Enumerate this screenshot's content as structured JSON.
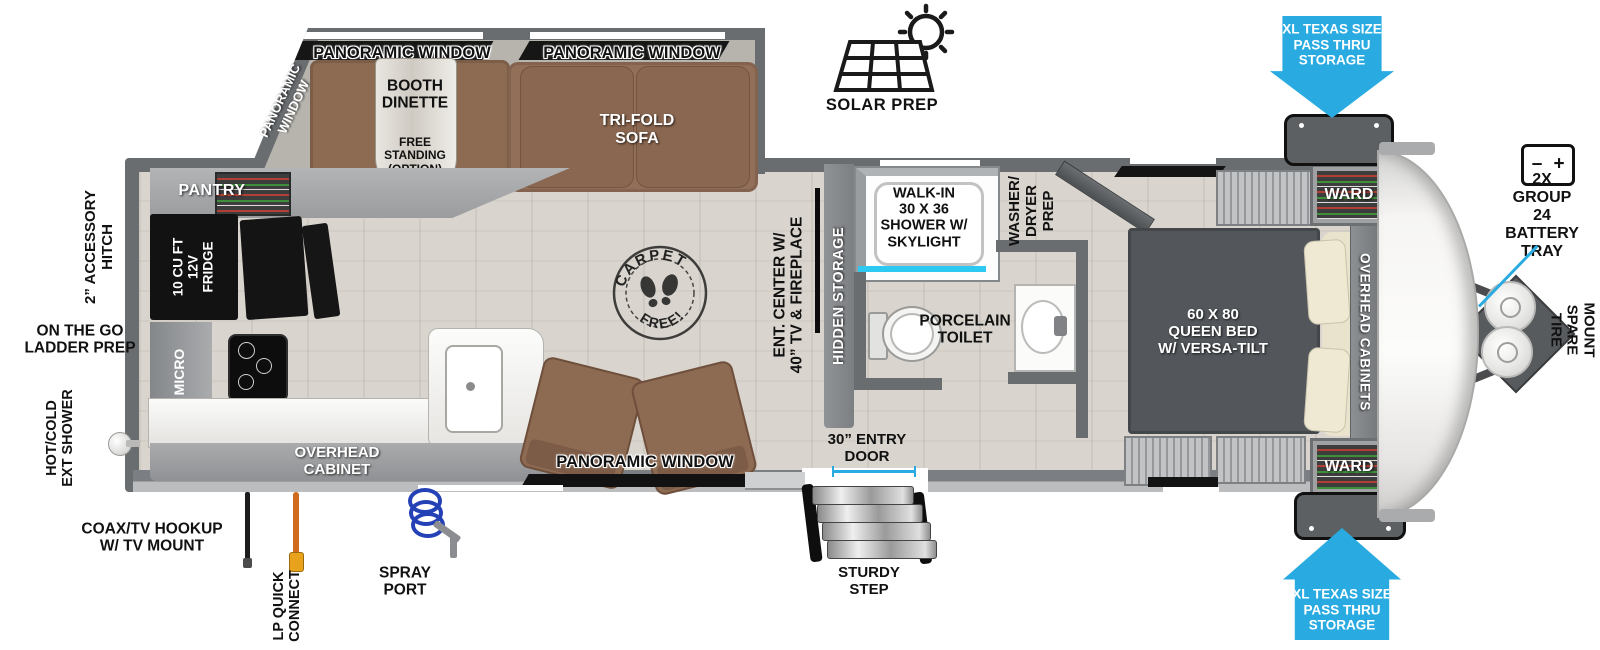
{
  "colors": {
    "arrow_blue": "#29abe2",
    "cyan_accent": "#2ec9f2",
    "wall_gray": "#6a6d70",
    "bed_gray": "#53575b",
    "sofa_brown": "#926f58",
    "floor_beige": "#d9d5ce"
  },
  "exterior": {
    "accessory_hitch": "2” ACCESSORY\nHITCH",
    "ladder_prep": "ON THE GO\nLADDER PREP",
    "ext_shower": "HOT/COLD\nEXT SHOWER",
    "coax": "COAX/TV HOOKUP\nW/ TV MOUNT",
    "lp_quick_connect": "LP QUICK\nCONNECT",
    "spray_port": "SPRAY\nPORT",
    "solar_prep": "SOLAR PREP",
    "pass_thru_top": "XL TEXAS SIZE\nPASS THRU\nSTORAGE",
    "pass_thru_bottom": "XL TEXAS SIZE\nPASS THRU\nSTORAGE",
    "battery_tray": "2X GROUP 24\nBATTERY\nTRAY",
    "battery_minus": "–",
    "battery_plus": "+",
    "spare_tire": "UNDER-MOUNT\nSPARE TIRE",
    "entry_door": "30” ENTRY\nDOOR",
    "sturdy_step": "STURDY\nSTEP"
  },
  "interior": {
    "panoramic_window_top_left": "PANORAMIC WINDOW",
    "panoramic_window_top_right": "PANORAMIC WINDOW",
    "panoramic_window_corner": "PANORAMIC\nWINDOW",
    "panoramic_window_bottom": "PANORAMIC WINDOW",
    "booth_dinette": "BOOTH\nDINETTE",
    "free_standing_option": "FREE\nSTANDING\n(OPTION)",
    "tri_fold_sofa": "TRI-FOLD\nSOFA",
    "pantry": "PANTRY",
    "fridge": "10 CU FT\n12V\nFRIDGE",
    "micro": "MICRO",
    "overhead_cabinet": "OVERHEAD\nCABINET",
    "carpet_free_top": "CARPET",
    "carpet_free_bottom": "FREE!",
    "ent_center": "ENT. CENTER W/\n40” TV & FIREPLACE",
    "hidden_storage": "HIDDEN STORAGE",
    "shower": "WALK-IN\n30 X 36\nSHOWER W/\nSKYLIGHT",
    "porcelain_toilet": "PORCELAIN\nTOILET",
    "washer_dryer_prep": "WASHER/\nDRYER\nPREP",
    "queen_bed": "60 X 80\nQUEEN BED\nW/ VERSA-TILT",
    "overhead_cabinets": "OVERHEAD CABINETS",
    "ward_top": "WARD",
    "ward_bottom": "WARD"
  }
}
